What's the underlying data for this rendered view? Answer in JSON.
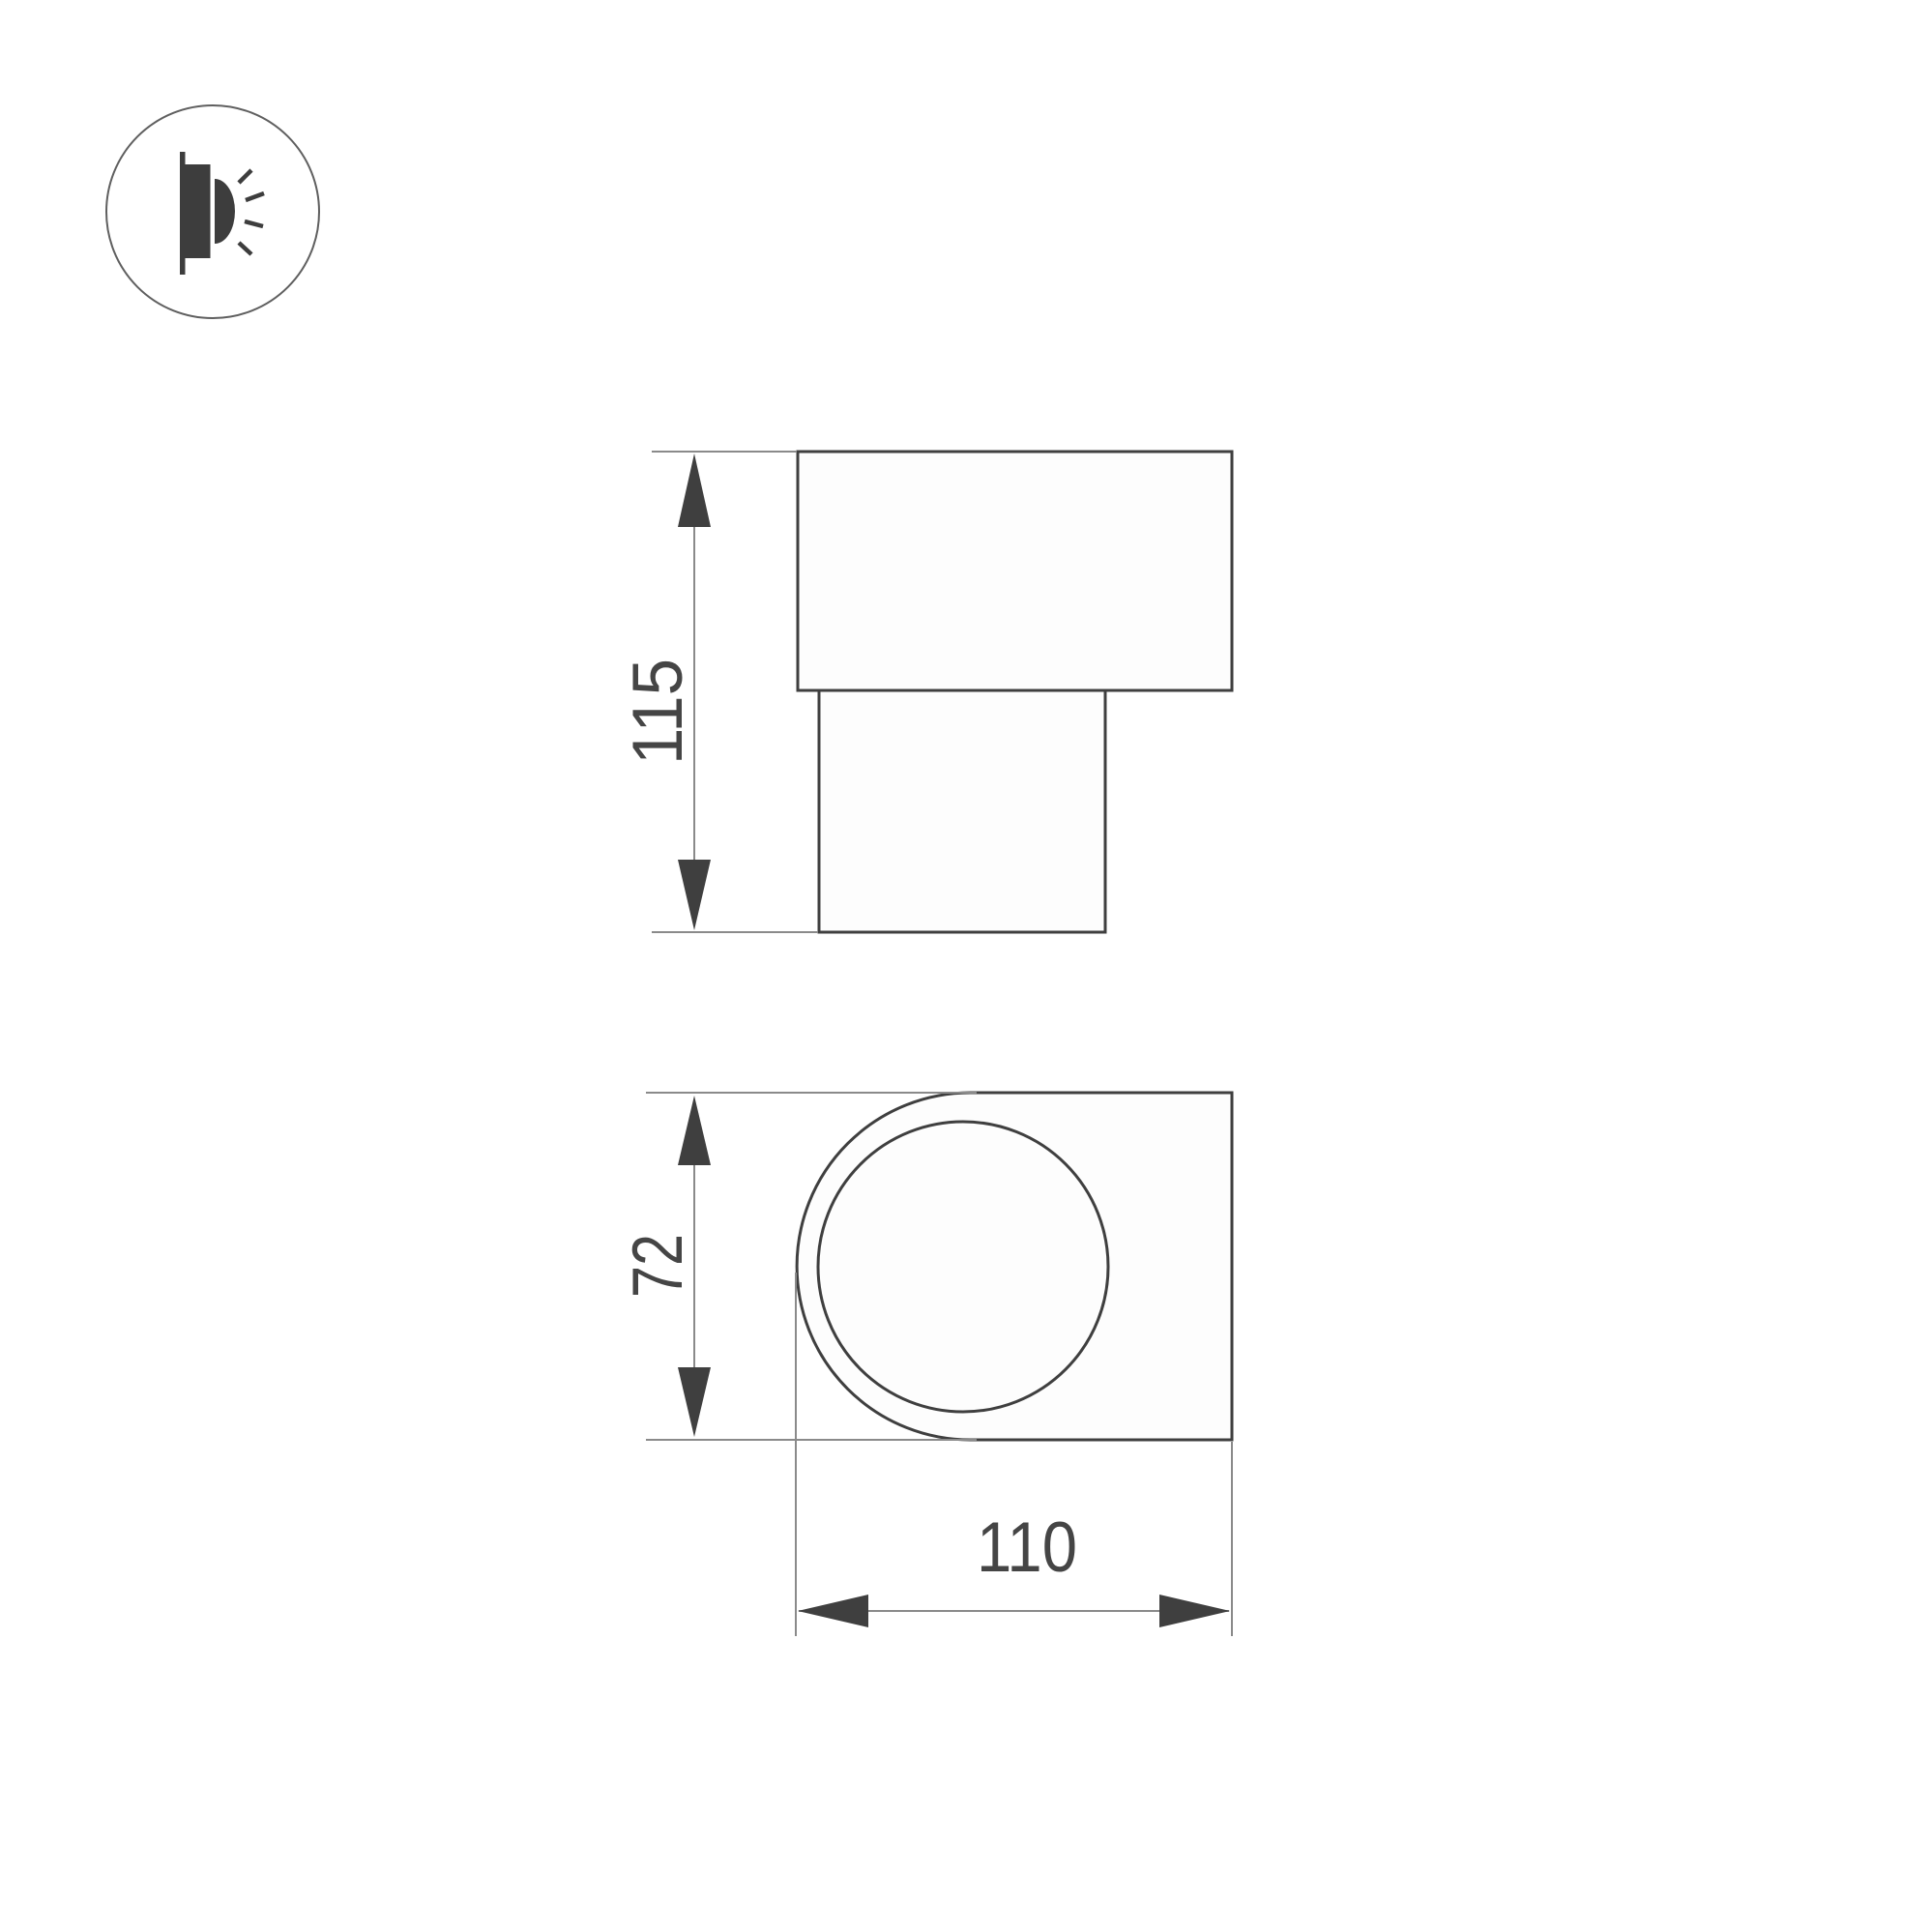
{
  "canvas": {
    "background": "#ffffff"
  },
  "logo": {
    "icon": "wall-lamp-glow-icon",
    "ring_color": "#5f5f5f",
    "glyph_color": "#3d3d3d"
  },
  "drawing": {
    "colors": {
      "outline": "#3f3f3f",
      "thin_line": "#8a8a8a",
      "arrow": "#3f3f3f",
      "label": "#454545",
      "shape_fill": "#fdfdfd"
    },
    "side_view": {
      "height_dimension": "115"
    },
    "front_view": {
      "height_dimension": "72",
      "width_dimension": "110"
    }
  }
}
